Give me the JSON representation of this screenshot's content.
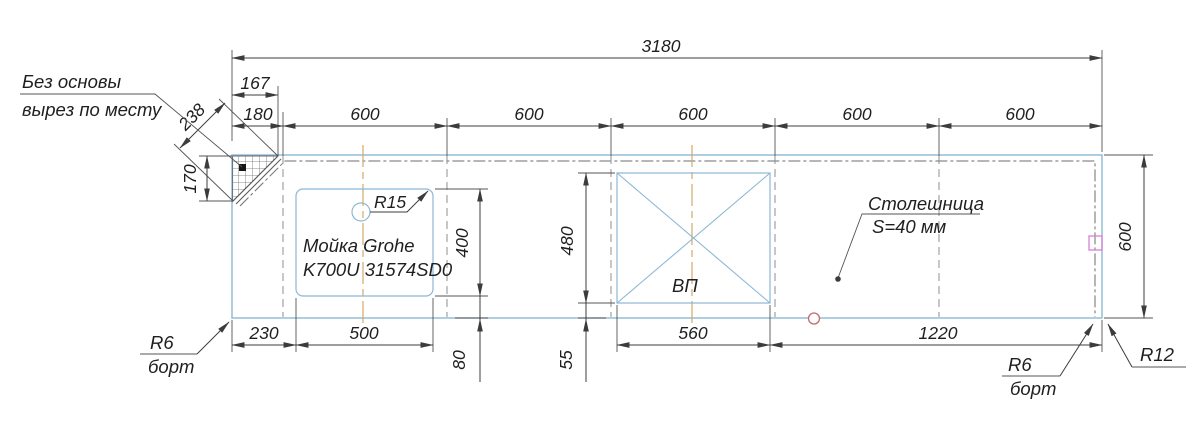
{
  "drawing": {
    "notes": {
      "corner_note_line1": "Без основы",
      "corner_note_line2": "вырез по месту",
      "countertop_label_line1": "Столешница",
      "countertop_label_line2": "S=40 мм",
      "sink_label_line1": "Мойка Grohe",
      "sink_label_line2": "K700U 31574SD0",
      "sink_hole_radius": "R15",
      "cooktop_label": "ВП",
      "edge_left_radius": "R6",
      "edge_left_label": "борт",
      "edge_right_radius": "R6",
      "edge_right_label": "борт",
      "corner_radius_label": "R12"
    },
    "dims": {
      "overall_length": "3180",
      "cut_width": "167",
      "first_offset": "180",
      "cut_diagonal": "238",
      "cut_height": "170",
      "segments": [
        "600",
        "600",
        "600",
        "600",
        "600"
      ],
      "depth": "600",
      "sink_offset": "230",
      "sink_width": "500",
      "sink_depth": "400",
      "sink_front": "80",
      "cooktop_width": "560",
      "cooktop_depth": "480",
      "cooktop_front": "55",
      "right_span": "1220"
    },
    "colors": {
      "outline": "#8cb8d6",
      "dims": "#3c3c3c",
      "text": "#1f1f1f",
      "dashed": "#8f8f8f",
      "dashdot": "#6e6e6e",
      "centerline": "#d2a96a",
      "hatch": "#6a6a6a",
      "red_marker": "#c86a6a",
      "magenta_marker": "#d87fd8"
    }
  }
}
